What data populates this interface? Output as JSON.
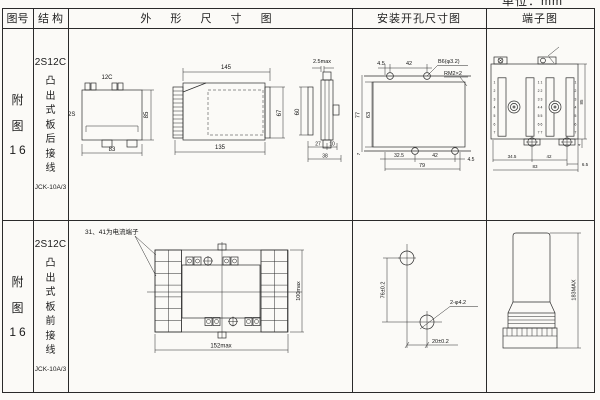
{
  "unit_label": "单位：mm",
  "header": {
    "fig_no": "图号",
    "structure": "结 构",
    "outline": "外 形 尺 寸 图",
    "install": "安装开孔尺寸图",
    "terminal": "端子图"
  },
  "rows": [
    {
      "fig_no": [
        "附",
        "图",
        "16"
      ],
      "model": "2S12C",
      "mount": "凸出式板后接线",
      "type_code": "JCK-10A/3",
      "outline": {
        "front_top": "12C",
        "front_side": "2S",
        "front_h": "85",
        "front_w": "83",
        "side_top": "145",
        "side_bottom": "135",
        "side_h": "67",
        "edge_top": "2.5max",
        "edge_h": "60",
        "edge_d1": "27",
        "edge_d2": "10",
        "edge_w": "38"
      },
      "install": {
        "t1": "4.5",
        "t2": "42",
        "hole_label": "B6(φ3.2)",
        "thread_label": "RM2×2",
        "h_out": "77",
        "h_in": "63",
        "b0": "7",
        "b1": "32.5",
        "b2": "42",
        "b3": "4.5",
        "b_total": "79"
      },
      "terminal": {
        "rows_left": [
          "1",
          "2",
          "3",
          "4",
          "5",
          "6",
          "7"
        ],
        "rows_center": [
          "1 1",
          "2 2",
          "3 3",
          "4 4",
          "5 5",
          "6 6",
          "7 7"
        ],
        "rows_right": [
          "1",
          "2",
          "3",
          "4",
          "5",
          "6",
          "7"
        ],
        "b1": "34.5",
        "b2": "42",
        "b3": "6.5",
        "b_total": "83",
        "side_h": "85",
        "foot": "4"
      }
    },
    {
      "fig_no": [
        "附",
        "图",
        "16"
      ],
      "model": "2S12C",
      "mount": "凸出式板前接线",
      "type_code": "JCK-10A/3",
      "outline": {
        "note": "31、41为电流端子",
        "w": "152max",
        "h": "100max"
      },
      "install": {
        "v": "76±0.2",
        "hole": "2-φ4.2",
        "h": "20±0.2"
      },
      "terminal": {
        "h": "183MAX"
      }
    }
  ]
}
